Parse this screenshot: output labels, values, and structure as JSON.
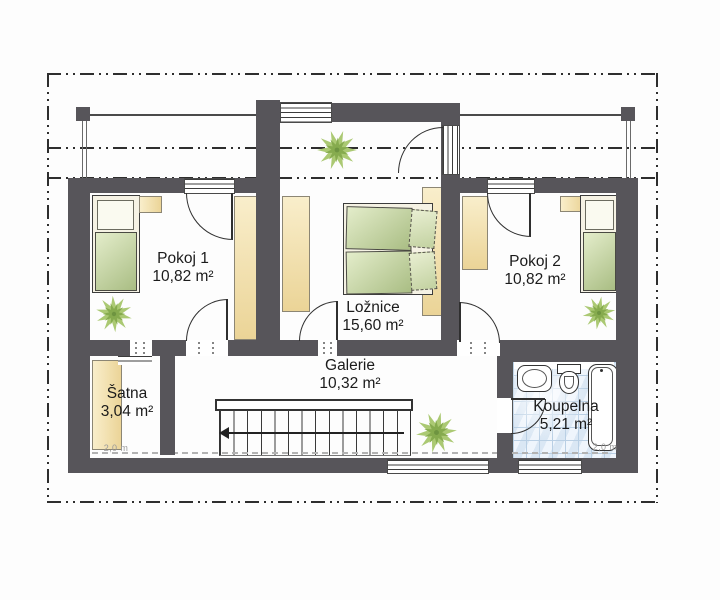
{
  "rooms": [
    {
      "name": "Pokoj 1",
      "area": "10,82 m²"
    },
    {
      "name": "Ložnice",
      "area": "15,60 m²"
    },
    {
      "name": "Pokoj 2",
      "area": "10,82 m²"
    },
    {
      "name": "Šatna",
      "area": "3,04 m²"
    },
    {
      "name": "Galerie",
      "area": "10,32 m²"
    },
    {
      "name": "Koupelna",
      "area": "5,21 m²"
    }
  ],
  "height_markers": [
    {
      "label": "2,0 m"
    },
    {
      "label": "2,0 m"
    }
  ],
  "colors": {
    "wall": "#57555a",
    "furniture_tan": "#f2dfa8",
    "bed_green": "#a9bd83",
    "plant_green": "#a7c96d",
    "tile_blue": "#e7f0fa",
    "marker_gray": "#9a9a9a"
  }
}
